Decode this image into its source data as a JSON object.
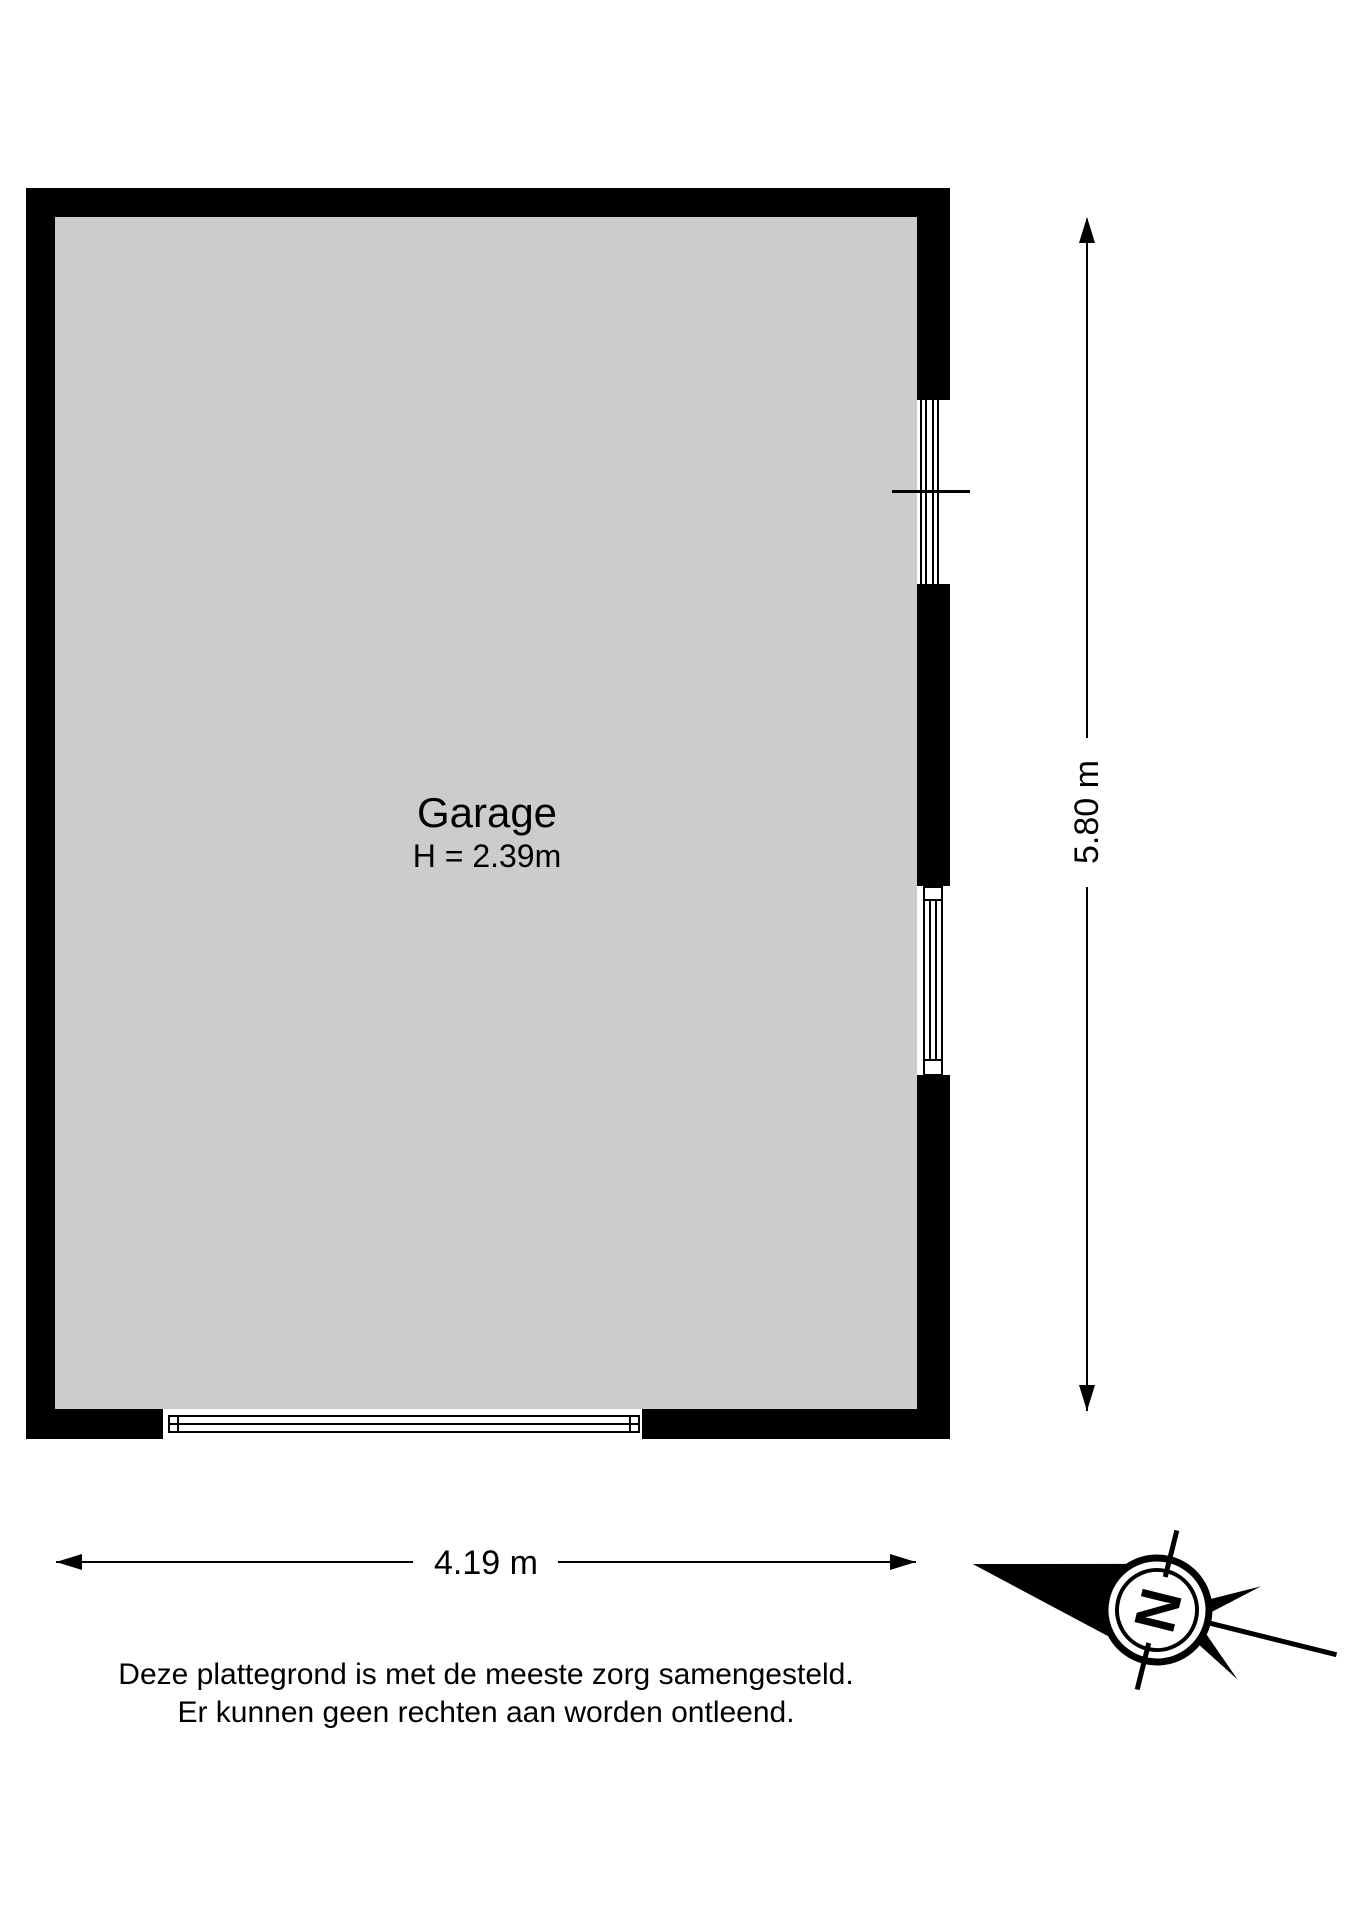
{
  "floorplan": {
    "room": {
      "name": "Garage",
      "height_note": "H = 2.39m"
    },
    "dimensions": {
      "width_label": "4.19 m",
      "height_label": "5.80 m"
    },
    "compass": {
      "letter": "N"
    },
    "disclaimer": {
      "line1": "Deze plattegrond is met de meeste zorg samengesteld.",
      "line2": "Er kunnen geen rechten aan worden ontleend."
    },
    "colors": {
      "wall": "#000000",
      "floor": "#cccccc",
      "background": "#ffffff"
    }
  }
}
